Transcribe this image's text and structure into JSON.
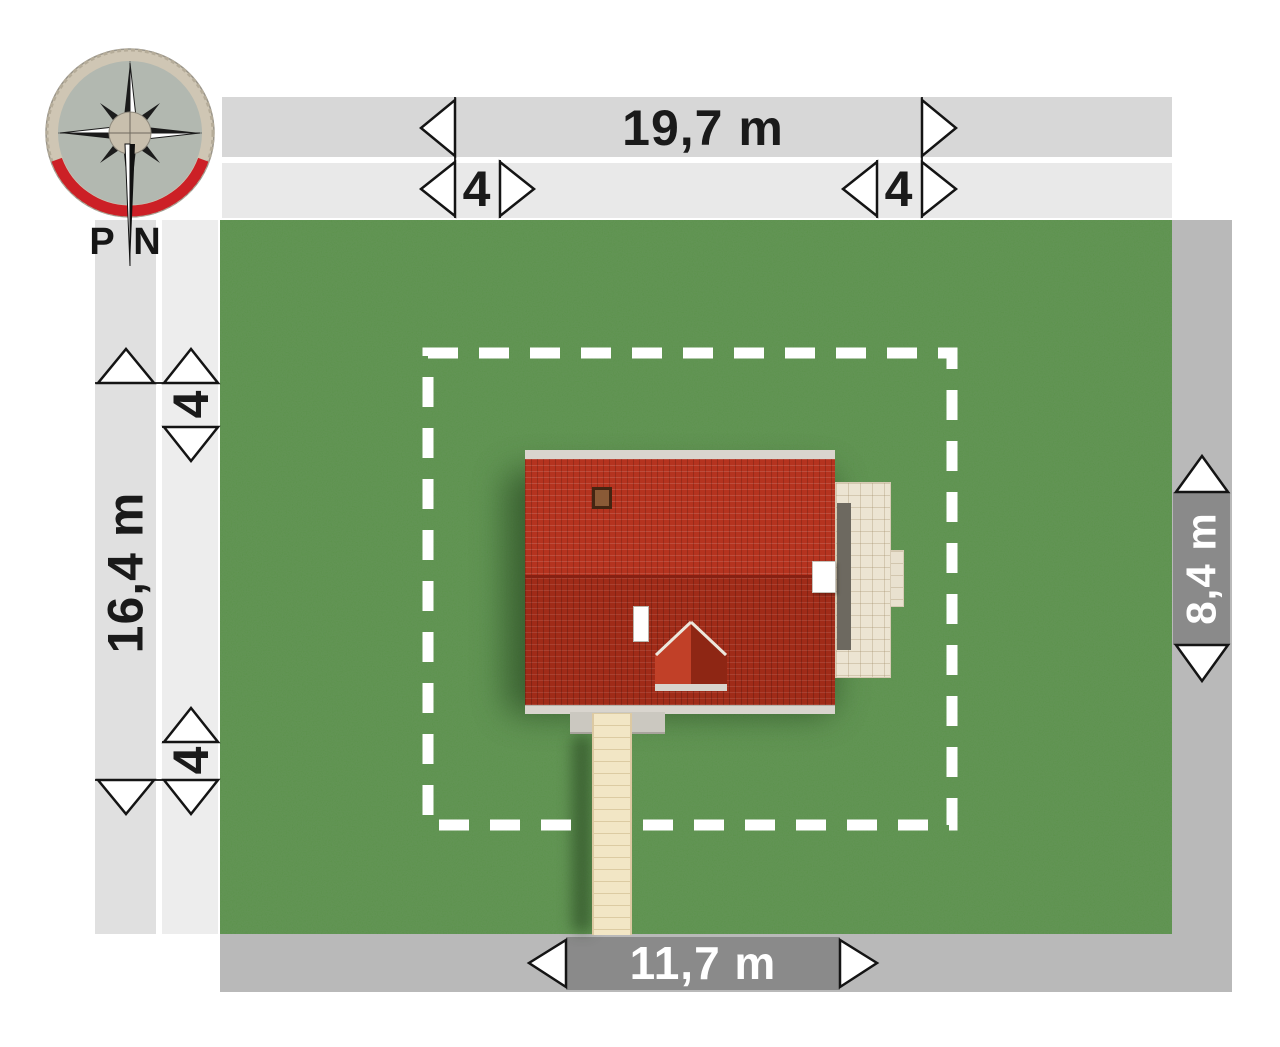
{
  "title": "House site plan (top view)",
  "compass": {
    "south_label": "P",
    "north_label": "N"
  },
  "dims": {
    "plot_width": "19,7 m",
    "plot_depth": "16,4 m",
    "house_width": "11,7 m",
    "house_depth": "8,4 m",
    "setback_top_left": "4",
    "setback_top_right": "4",
    "setback_left_top": "4",
    "setback_left_bottom": "4"
  },
  "colors": {
    "grass": "#4d8a3c",
    "roof_upper": "#b5331f",
    "roof_lower": "#a02b18",
    "terrace": "#ece4d2",
    "walkway": "#f2e6c5",
    "band_top_outer": "#d7d7d7",
    "band_top_inner": "#e9e9e9",
    "band_left_outer": "#e0e0e0",
    "band_left_inner": "#ededed",
    "band_right_bottom": "#b9b9b9",
    "dim_segment_dark": "#8a8a8a",
    "dashed_boundary": "#ffffff",
    "compass_red_arc": "#cc2026"
  }
}
